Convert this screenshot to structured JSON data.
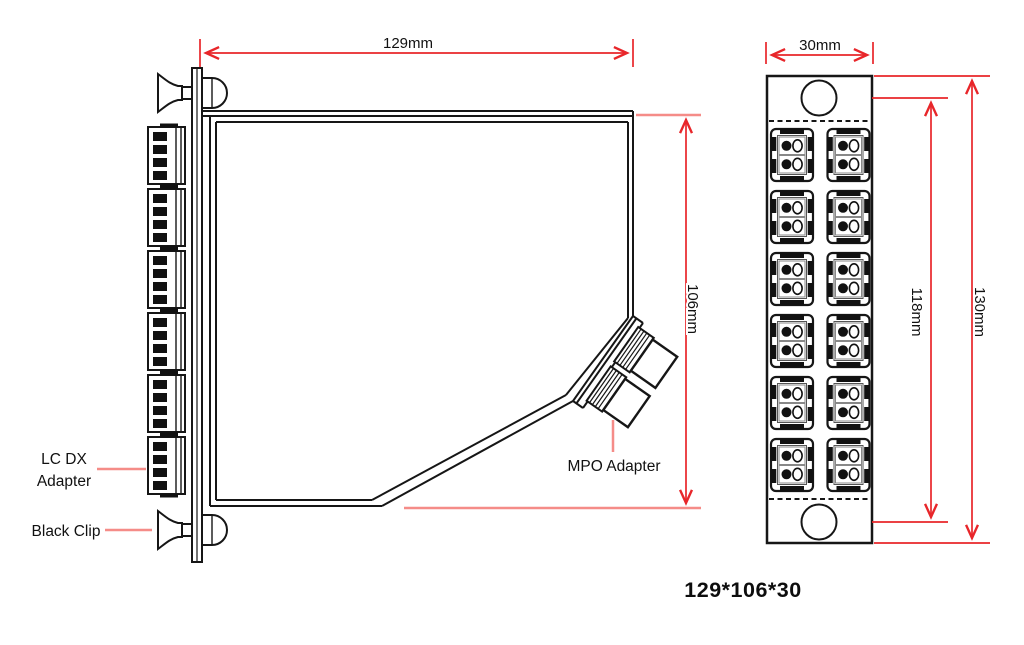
{
  "side_view": {
    "dim_width": "129mm",
    "dim_height": "106mm",
    "label_lc_dx_line1": "LC DX",
    "label_lc_dx_line2": "Adapter",
    "label_black_clip": "Black Clip",
    "label_mpo_adapter": "MPO Adapter",
    "lc_adapter_count": 6,
    "mpo_adapter_count": 2,
    "clip_count": 2
  },
  "front_view": {
    "dim_width": "30mm",
    "dim_hole_pitch": "118mm",
    "dim_height": "130mm",
    "adapter_rows": 6,
    "adapter_columns": 2,
    "mounting_hole_count": 2
  },
  "footer": {
    "overall_size": "129*106*30"
  },
  "colors": {
    "outline": "#161616",
    "dimension_red": "#e8262a",
    "pointer_red": "#f58c88",
    "background": "#ffffff"
  }
}
